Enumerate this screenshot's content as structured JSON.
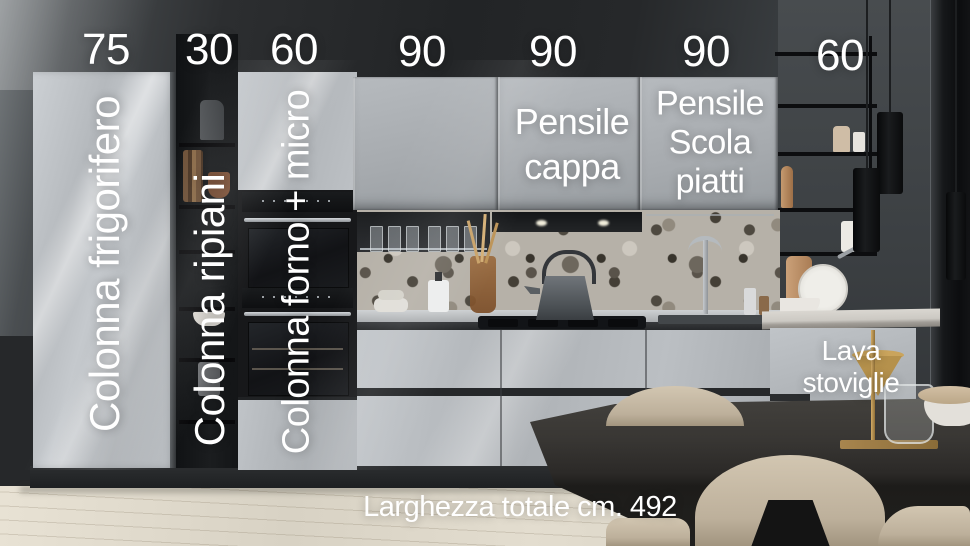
{
  "annotations": {
    "dimensions": [
      {
        "value": "75"
      },
      {
        "value": "30"
      },
      {
        "value": "60"
      },
      {
        "value": "90"
      },
      {
        "value": "90"
      },
      {
        "value": "90"
      },
      {
        "value": "60"
      }
    ],
    "columns": [
      {
        "label": "Colonna frigorifero"
      },
      {
        "label": "Colonna ripiani"
      },
      {
        "label": "Colonna forno + micro"
      }
    ],
    "wall_units": [
      {
        "label": "Pensile cappa"
      },
      {
        "label": "Pensile Scola piatti"
      }
    ],
    "base_units": [
      {
        "label": "Lava stoviglie"
      }
    ],
    "total_width": "Larghezza totale cm. 492"
  },
  "colors": {
    "annotation_text": "#ffffff",
    "cabinet_gray": "#b7bbbf",
    "dark_wall": "#26282a",
    "wood_floor": "#ddd7ca",
    "table_dark": "#2b2927",
    "chair_beige": "#c9bca7",
    "accent_gold": "#b08d4a"
  }
}
